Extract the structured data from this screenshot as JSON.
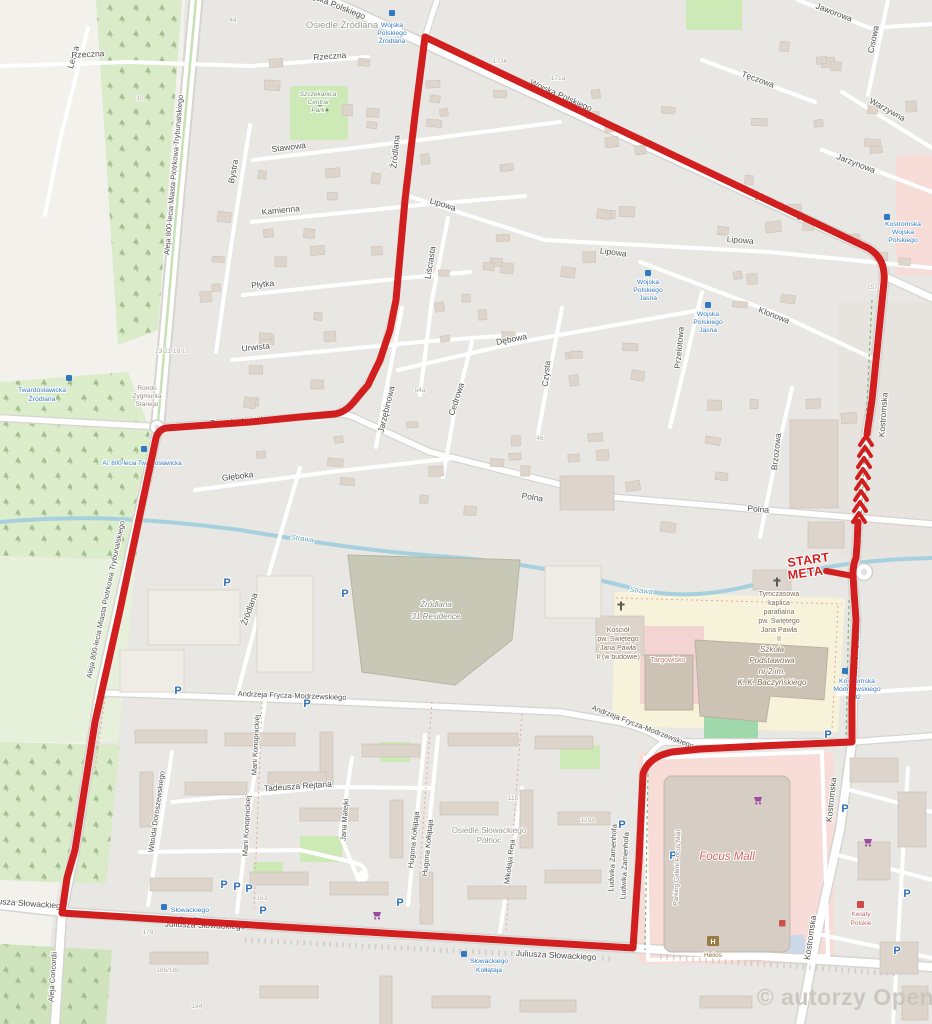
{
  "map": {
    "attribution": "© autorzy OpenStreetMap.org",
    "route": {
      "start": "START",
      "meta": "META"
    },
    "streets": {
      "letnia": "Letnia",
      "rzeczna": "Rzeczna",
      "stawowa": "Stawowa",
      "bystra": "Bystra",
      "kamienna": "Kamienna",
      "plytka": "Płytka",
      "urwista": "Urwista",
      "gleboka": "Głęboka",
      "aleja_800lecia": "Aleja 800-lecia Miasta Piotrkowa Trybunalskiego",
      "twardoslawicka": "Twardosławicka",
      "zrodlana": "Źródlana",
      "lipowa": "Lipowa",
      "lisciasta": "Liściasta",
      "debowa": "Dębowa",
      "czysta": "Czysta",
      "cedrowa": "Cedrowa",
      "jarzebinowa": "Jarzębinowa",
      "przelotowa": "Przelotowa",
      "klonowa": "Klonowa",
      "brzozowa": "Brzozowa",
      "teczowa": "Tęczowa",
      "jaworowa": "Jaworowa",
      "cisowa": "Cisowa",
      "warzywna": "Warzywna",
      "jarzynowa": "Jarzynowa",
      "wojska_polskiego": "Wojska Polskiego",
      "kostromska": "Kostromska",
      "polna": "Polna",
      "frycza_modrzewskiego": "Andrzeja Frycza-Modrzewskiego",
      "konopnickiej": "Marii Konopnickiej",
      "doroszewskiego": "Witolda Doroszewskiego",
      "rejtana": "Tadeusza Rejtana",
      "matejki": "Jana Matejki",
      "kollataja": "Hugona Kołłątaja",
      "reja": "Mikołaja Reja",
      "zamenhofa": "Ludwika Zamenhofa",
      "slowackiego": "Juliusza Słowackiego",
      "concordii": "Aleja Concordii"
    },
    "places": {
      "osiedle_zrodlana": "Osiedle Źródlana",
      "park_l1": "Szczekanica",
      "park_l2": "Central",
      "park_l3": "Park",
      "residence_l1": "Źródlana",
      "residence_l2": "31 Residence",
      "rondo_l1": "Rondo",
      "rondo_l2": "Zygmunta",
      "rondo_l3": "Starego",
      "kosciol_l1": "Kościół",
      "kosciol_l2": "pw. Świętego",
      "kosciol_l3": "Jana Pawła",
      "kosciol_l4": "II (w budowie)",
      "kaplica_l1": "Tymczasowa",
      "kaplica_l2": "kaplica",
      "kaplica_l3": "parafialna",
      "kaplica_l4": "pw. Świętego",
      "kaplica_l5": "Jana Pawła",
      "kaplica_l6": "II",
      "szkola_l1": "Szkoła",
      "szkola_l2": "Podstawowa",
      "szkola_l3": "nr 2 im.",
      "szkola_l4": "K. K. Baczyńskiego",
      "targowisko": "Targowisko",
      "focus_mall": "Focus Mall",
      "parking_galerii": "Parking Galerii Focus Mall",
      "helios": "Helios",
      "kwiaty_l1": "Kwiaty",
      "kwiaty_l2": "Polskie",
      "osiedle_slow_l1": "Osiedle Słowackiego",
      "osiedle_slow_l2": "Północ",
      "strawa": "Strawa"
    },
    "transit": {
      "wp_zrodlana_l1": "Wojska",
      "wp_zrodlana_l2": "Polskiego",
      "wp_zrodlana_l3": "Źródlana",
      "wp_jasna_l1": "Wojska",
      "wp_jasna_l2": "Polskiego",
      "wp_jasna_l3": "Jasna",
      "kostromska_wp_l1": "Kostromska",
      "kostromska_wp_l2": "Wojska",
      "kostromska_wp_l3": "Polskiego",
      "tw_zrodlana_l1": "Twardosławicka",
      "tw_zrodlana_l2": "Źródlana",
      "al800_tw": "Al. 800-lecia Twardosławicka",
      "kostr_modrz_l1": "Kostromska",
      "kostr_modrz_l2": "Modrzewskiego",
      "kostr_modrz_l3": "02",
      "slow_osiedle_l1": "Słowackiego",
      "slow_osiedle_l2": "Osiedle",
      "slow_kollataja_l1": "Słowackiego",
      "slow_kollataja_l2": "Kołłątaja"
    },
    "house_numbers": [
      "44",
      "1736",
      "171a",
      "10",
      "23 21 19 17",
      "54a",
      "157 40",
      "163",
      "179",
      "186/188",
      "184",
      "129A",
      "115",
      "1a",
      "46"
    ],
    "icons": {
      "parking": "P",
      "helios_h": "H"
    },
    "colors": {
      "route": "#d11f1f",
      "water": "#a6d0dd",
      "transit_blue": "#3079c0",
      "focus_label": "#d4636a"
    }
  }
}
